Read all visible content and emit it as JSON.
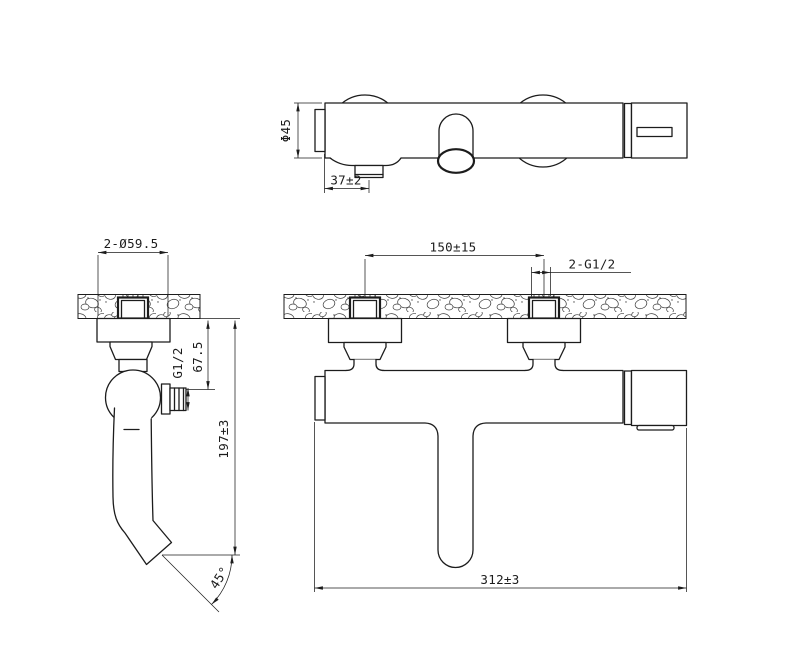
{
  "drawing": {
    "background": "#ffffff",
    "line_color": "#1c1c1c",
    "views": {
      "top": {
        "labels": {
          "body_diameter": "Φ45",
          "spout_offset": "37±2"
        }
      },
      "side": {
        "labels": {
          "escutcheon_diameter": "2-Ø59.5",
          "outlet_thread": "G1/2",
          "outlet_drop": "67.5",
          "overall_height": "197±3",
          "spout_angle": "45°"
        }
      },
      "front": {
        "labels": {
          "inlet_spacing": "150±15",
          "inlet_thread": "2-G1/2",
          "overall_width": "312±3"
        }
      }
    }
  }
}
